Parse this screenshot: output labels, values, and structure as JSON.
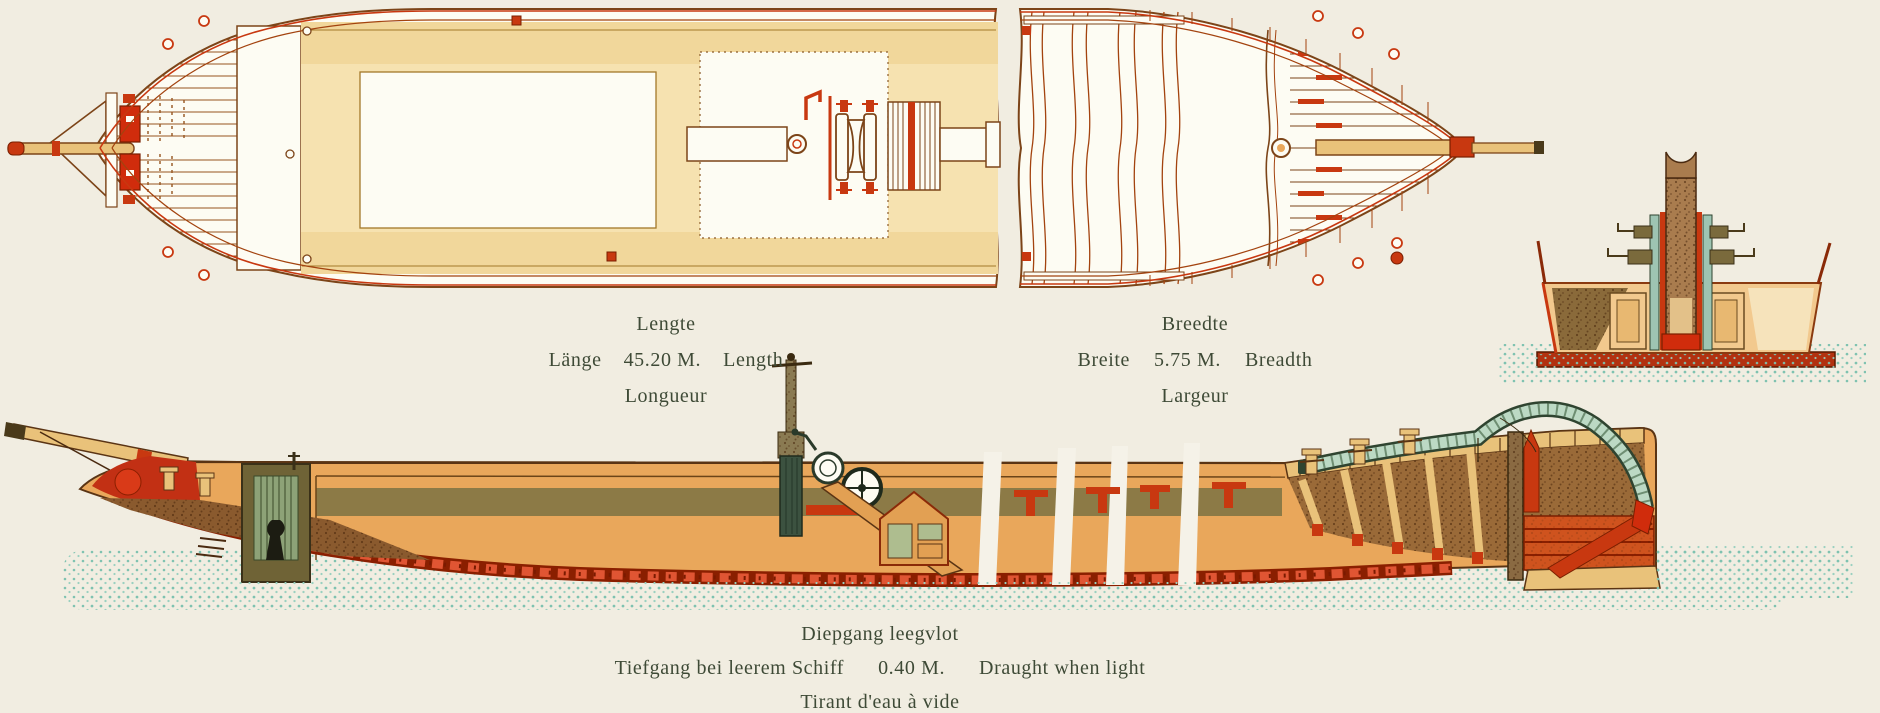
{
  "palette": {
    "background": "#f1ede1",
    "ink_red": "#c83810",
    "deep_red": "#d02c0c",
    "line_brown": "#7c4418",
    "deck_cream": "#f6e2b0",
    "hull_orange": "#e9a75b",
    "timber_tan": "#e9c27a",
    "olive_band": "#8c7a46",
    "mast_green": "#3c5240",
    "tiller_arm_green": "#bcd9c4",
    "water_teal": "#7fc2b0",
    "text_olive": "#3e4a36"
  },
  "labels": {
    "length": {
      "nl": "Lengte",
      "de": "Länge",
      "value": "45.20 M.",
      "en": "Length",
      "fr": "Longueur"
    },
    "breadth": {
      "nl": "Breedte",
      "de": "Breite",
      "value": "5.75 M.",
      "en": "Breadth",
      "fr": "Largeur"
    },
    "draught": {
      "nl": "Diepgang leegvlot",
      "de": "Tiefgang bei leerem Schiff",
      "value": "0.40 M.",
      "en": "Draught when light",
      "fr": "Tirant d'eau à vide"
    }
  }
}
